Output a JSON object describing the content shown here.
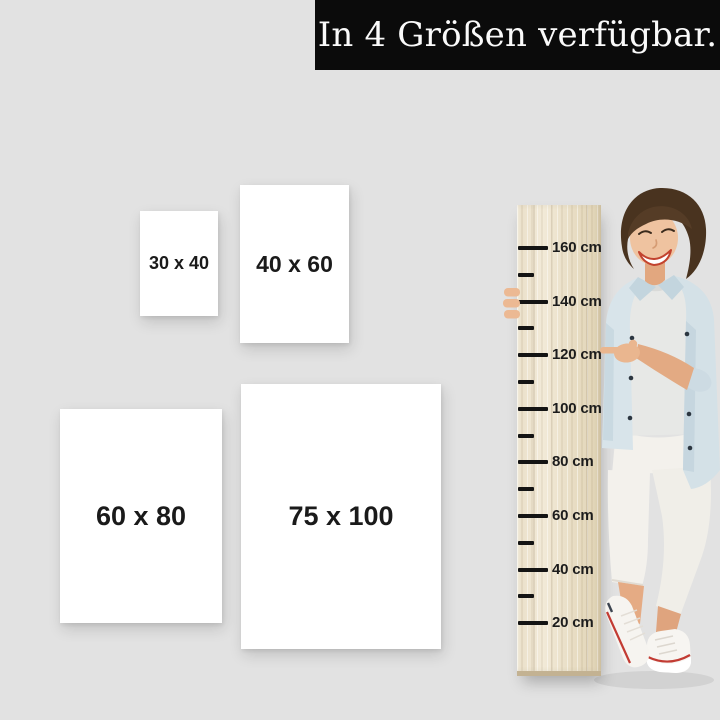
{
  "banner": {
    "text": "In 4 Größen verfügbar."
  },
  "size_cards": [
    {
      "name": "30x40",
      "label": "30 x 40"
    },
    {
      "name": "40x60",
      "label": "40 x 60"
    },
    {
      "name": "60x80",
      "label": "60 x 80"
    },
    {
      "name": "75x100",
      "label": "75 x 100"
    }
  ],
  "ruler": {
    "tick_labels": [
      "160 cm",
      "140 cm",
      "120 cm",
      "100 cm",
      "80 cm",
      "60 cm",
      "40 cm",
      "20 cm"
    ]
  },
  "colors": {
    "background": "#e2e2e2",
    "banner_background": "#0b0b0b",
    "banner_text": "#fafafa",
    "card_background": "#ffffff",
    "label_text": "#1a1a1a",
    "ruler_wood": "#ebe1ca",
    "ruler_tick": "#141414",
    "denim_jacket": "#d6e2e8",
    "sneaker_stripe": "#c23b33"
  }
}
